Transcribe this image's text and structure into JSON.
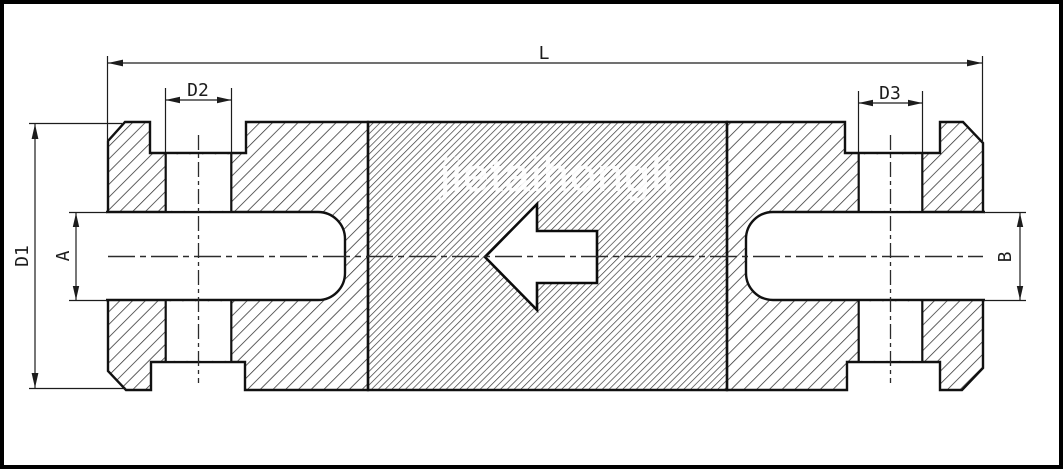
{
  "drawing": {
    "type": "flanged-valve-cross-section",
    "watermark": "jietaihongli",
    "labels": {
      "overall_length": "L",
      "flange_outer_diameter": "D1",
      "left_bolt_hole_diameter": "D2",
      "right_bolt_hole_diameter": "D3",
      "left_bore_diameter": "A",
      "right_bore_diameter": "B"
    },
    "flow_direction": "left",
    "colors": {
      "line": "#1c1c1c",
      "background": "#ffffff",
      "hatch_flange": "#2e2e2e",
      "hatch_body": "#3a3a3a",
      "watermark": "#ffffff"
    }
  }
}
